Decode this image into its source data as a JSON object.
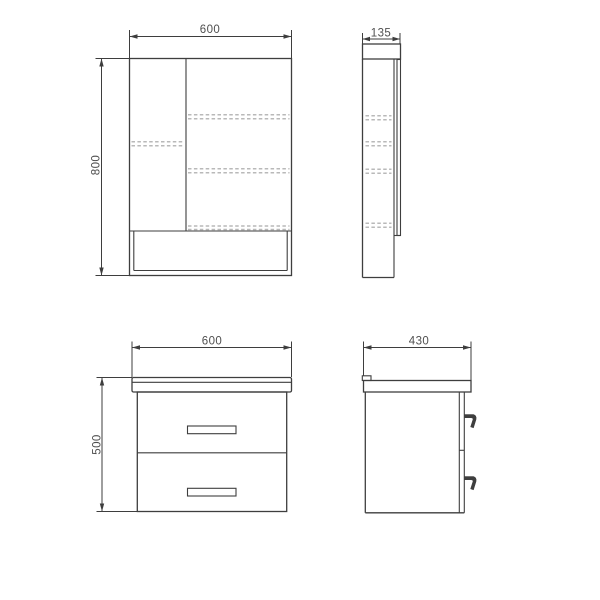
{
  "drawing": {
    "background": "#ffffff",
    "line_color": "#3e3e3e",
    "dashed_color": "#b9b9b9",
    "text_color": "#4f4f4f",
    "views": {
      "mirror_front": {
        "width": "600",
        "height": "800"
      },
      "mirror_side": {
        "depth": "135"
      },
      "vanity_front": {
        "width": "600",
        "height": "500"
      },
      "vanity_side": {
        "depth": "430"
      }
    }
  }
}
